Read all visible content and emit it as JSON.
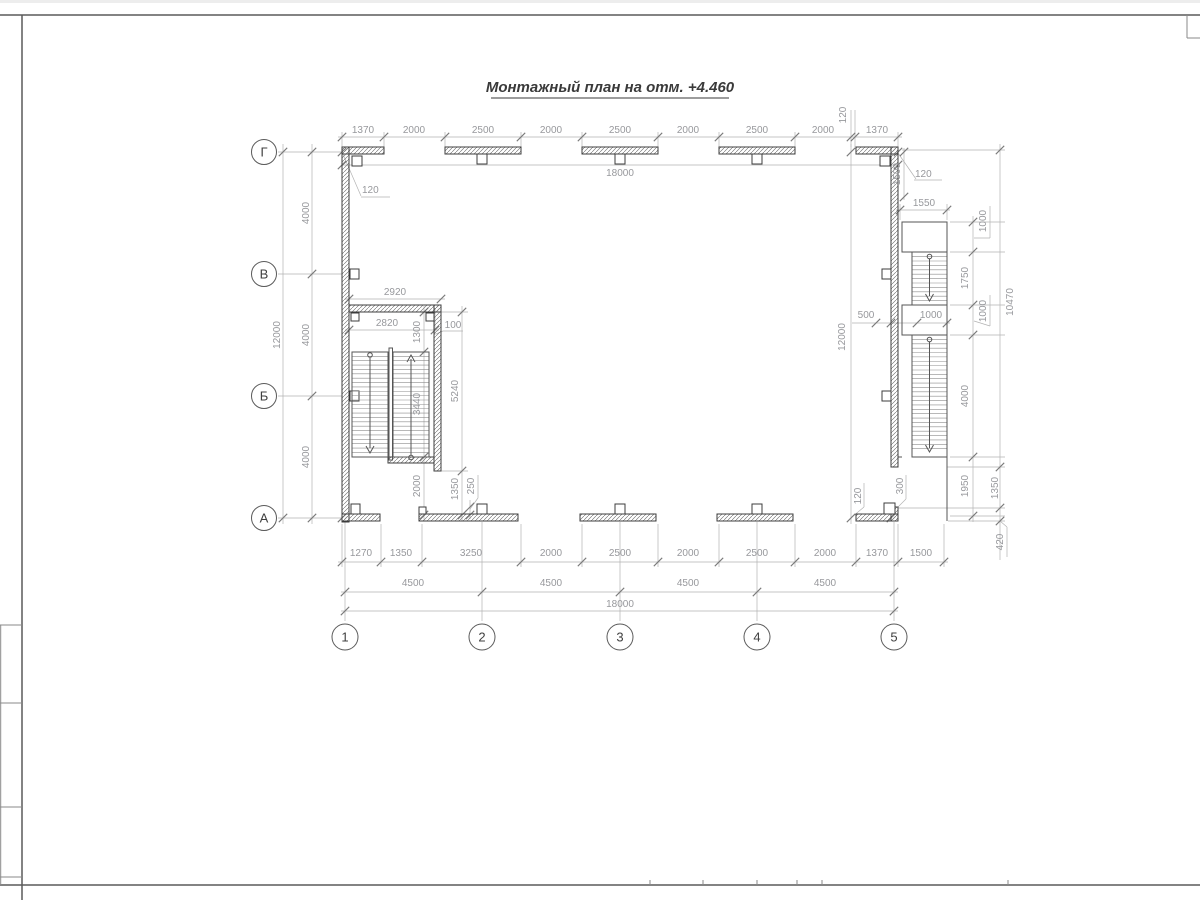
{
  "sheet": {
    "title": "Монтажный план на отм. +4.460"
  },
  "axes": {
    "rows": [
      "Г",
      "В",
      "Б",
      "А"
    ],
    "cols": [
      "1",
      "2",
      "3",
      "4",
      "5"
    ]
  },
  "dims": {
    "top": {
      "segments": [
        "1370",
        "2000",
        "2500",
        "2000",
        "2500",
        "2000",
        "2500",
        "2000",
        "120",
        "1370"
      ],
      "total": "18000"
    },
    "left": {
      "bays": [
        "4000",
        "4000",
        "4000"
      ],
      "total": "12000"
    },
    "bottom": {
      "segments": [
        "1270",
        "1350",
        "3250",
        "2000",
        "2500",
        "2000",
        "2500",
        "2000",
        "1370",
        "1500"
      ],
      "bays": [
        "4500",
        "4500",
        "4500",
        "4500"
      ],
      "total": "18000"
    },
    "offsets": {
      "top_left": "120"
    },
    "right": {
      "overall": "12000",
      "offset_top": "120",
      "offset_bottom": "120",
      "stair_offset": "1500",
      "stair_width": "1550",
      "landing_top": "1000",
      "flight1": "1750",
      "landing_mid": "1000",
      "clear": "500",
      "flight_width": "1000",
      "flight2": "4000",
      "below": "1950",
      "height": "10470",
      "lower": "1350",
      "edge": "420",
      "gap": "300"
    },
    "stair_left": {
      "outer": "2920",
      "inner": "2820",
      "wall": "100",
      "landing": "1300",
      "flight": "3440",
      "well": "5240",
      "below": "2000",
      "opening": "1350",
      "jamb": "250"
    }
  }
}
